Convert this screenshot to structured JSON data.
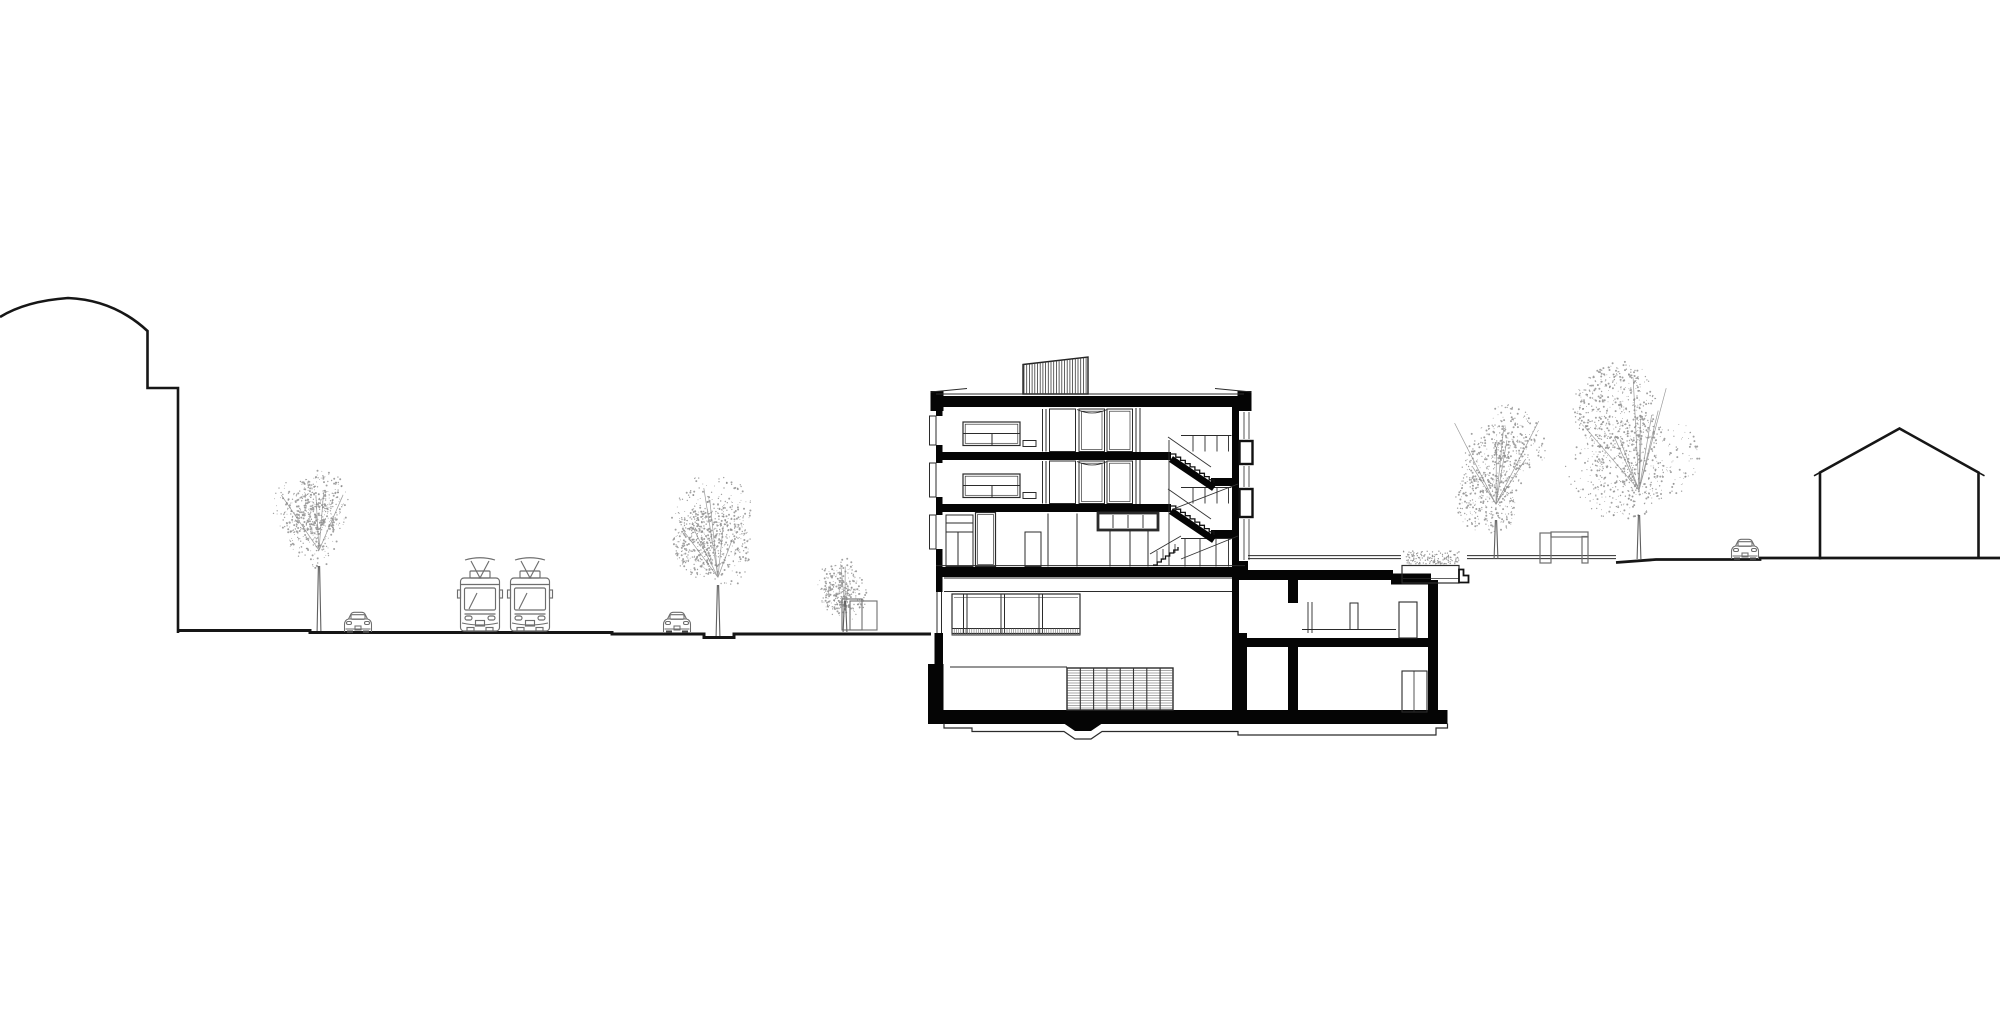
{
  "document": {
    "type": "architectural-section-elevation-drawing",
    "description": "Black and white architectural cross-section of a multi-storey building between a tram street (left) and a raised garden (right), flanked by a barrel-roof building silhouette on the left and a gabled house silhouette on the right",
    "background": "#ffffff"
  },
  "palette": {
    "ink": "#161616",
    "fill_black": "#050505",
    "thin_line": "#2b2b2b",
    "mid_gray": "#5f5f5f",
    "light_gray": "#8a8a8a",
    "foliage": "#878787",
    "white": "#ffffff"
  },
  "scene": {
    "context_buildings": {
      "left": {
        "type": "barrel-roof-silhouette",
        "x_range": [
          0,
          178
        ],
        "apex": [
          68,
          298
        ],
        "ground_y": 633
      },
      "right": {
        "type": "gabled-house-silhouette",
        "x_range": [
          1820,
          1978
        ],
        "ridge": [
          1900,
          428
        ],
        "eave_y": 472,
        "ground_y": 558
      }
    },
    "section_building": {
      "x_range": [
        928,
        1457
      ],
      "levels": {
        "roof_slab_y": 396,
        "floor3_slab_y": 452,
        "floor2_slab_y": 504,
        "deck_slab_y": 567,
        "basement_floor_y": 710,
        "foundation_bottom_y": 738
      },
      "storeys_above_deck": 3,
      "has_basement": true,
      "features": [
        "hatched rooftop skylight",
        "dog-leg staircase with landings",
        "entry stair",
        "basement ventilation grille",
        "garden-side lower wing",
        "terrace planter"
      ]
    },
    "street": {
      "ground_y": 632,
      "segments": "sidewalk-road-sidewalk with tree pit"
    },
    "garden": {
      "ground_y": 558,
      "features": [
        "pergola frame",
        "planter",
        "terrace lines"
      ]
    },
    "tram_y": 558,
    "trams": [
      {
        "x": 458
      },
      {
        "x": 508
      }
    ],
    "cars": [
      {
        "x": 343,
        "y": 611.5
      },
      {
        "x": 662,
        "y": 611.5
      },
      {
        "x": 1730,
        "y": 538.5
      }
    ],
    "trees": [
      {
        "cx": 315,
        "cy": 520,
        "rx": 50,
        "ry": 55,
        "trunk_x": 319,
        "ground_y": 631,
        "trunk_top": 566,
        "seed": 11,
        "dots": 620,
        "branches": 4
      },
      {
        "cx": 714,
        "cy": 540,
        "rx": 47,
        "ry": 68,
        "trunk_x": 718,
        "ground_y": 636,
        "trunk_top": 585,
        "seed": 22,
        "dots": 780,
        "branches": 6
      },
      {
        "cx": 843,
        "cy": 588,
        "rx": 27,
        "ry": 34,
        "trunk_x": 845,
        "ground_y": 632,
        "trunk_top": 601,
        "seed": 33,
        "dots": 330,
        "branches": 3
      },
      {
        "cx": 1494,
        "cy": 468,
        "rx": 59,
        "ry": 66,
        "trunk_x": 1496,
        "ground_y": 559,
        "trunk_top": 520,
        "seed": 44,
        "dots": 760,
        "branches": 7
      },
      {
        "cx": 1640,
        "cy": 443,
        "rx": 79,
        "ry": 86,
        "trunk_x": 1639,
        "ground_y": 559,
        "trunk_top": 515,
        "seed": 55,
        "dots": 1050,
        "branches": 9
      }
    ],
    "hedges": [
      {
        "x": 1403,
        "y": 551,
        "w": 57,
        "h": 13,
        "dots": 150,
        "seed": 7
      }
    ],
    "stairs": [
      {
        "x1": 1171,
        "y1": 454,
        "x2": 1214,
        "y2": 483,
        "n": 9,
        "band": true
      },
      {
        "x1": 1171,
        "y1": 506,
        "x2": 1214,
        "y2": 535,
        "n": 9,
        "band": true
      },
      {
        "x1": 1153,
        "y1": 565,
        "x2": 1178,
        "y2": 547,
        "n": 6,
        "band": false
      }
    ],
    "railings": [
      [
        1168,
        437,
        1211,
        467
      ],
      [
        1168,
        489,
        1211,
        519
      ],
      [
        1150,
        554,
        1181,
        536
      ],
      [
        1238,
        484,
        1172,
        509.5
      ],
      [
        1238,
        536,
        1181,
        559
      ]
    ],
    "hatches": [
      {
        "id": "skylight",
        "dir": "v",
        "x": 1024,
        "y": 355,
        "w": 64,
        "h": 39,
        "step": 2.7,
        "color": "#3a3a3a",
        "width": 0.8,
        "clip": "skylight-clip"
      },
      {
        "id": "grille-h",
        "dir": "h",
        "x": 1067,
        "y": 668,
        "w": 106,
        "h": 42,
        "step": 2.5,
        "color": "#555555",
        "width": 0.6
      },
      {
        "id": "grille-v",
        "dir": "v",
        "x": 1067,
        "y": 668,
        "w": 106,
        "h": 42,
        "step": 13.3,
        "color": "#333333",
        "width": 1.1
      },
      {
        "id": "sill",
        "dir": "v",
        "x": 952,
        "y": 628.5,
        "w": 128,
        "h": 6.5,
        "step": 2.2,
        "color": "#666666",
        "width": 0.55
      }
    ]
  }
}
